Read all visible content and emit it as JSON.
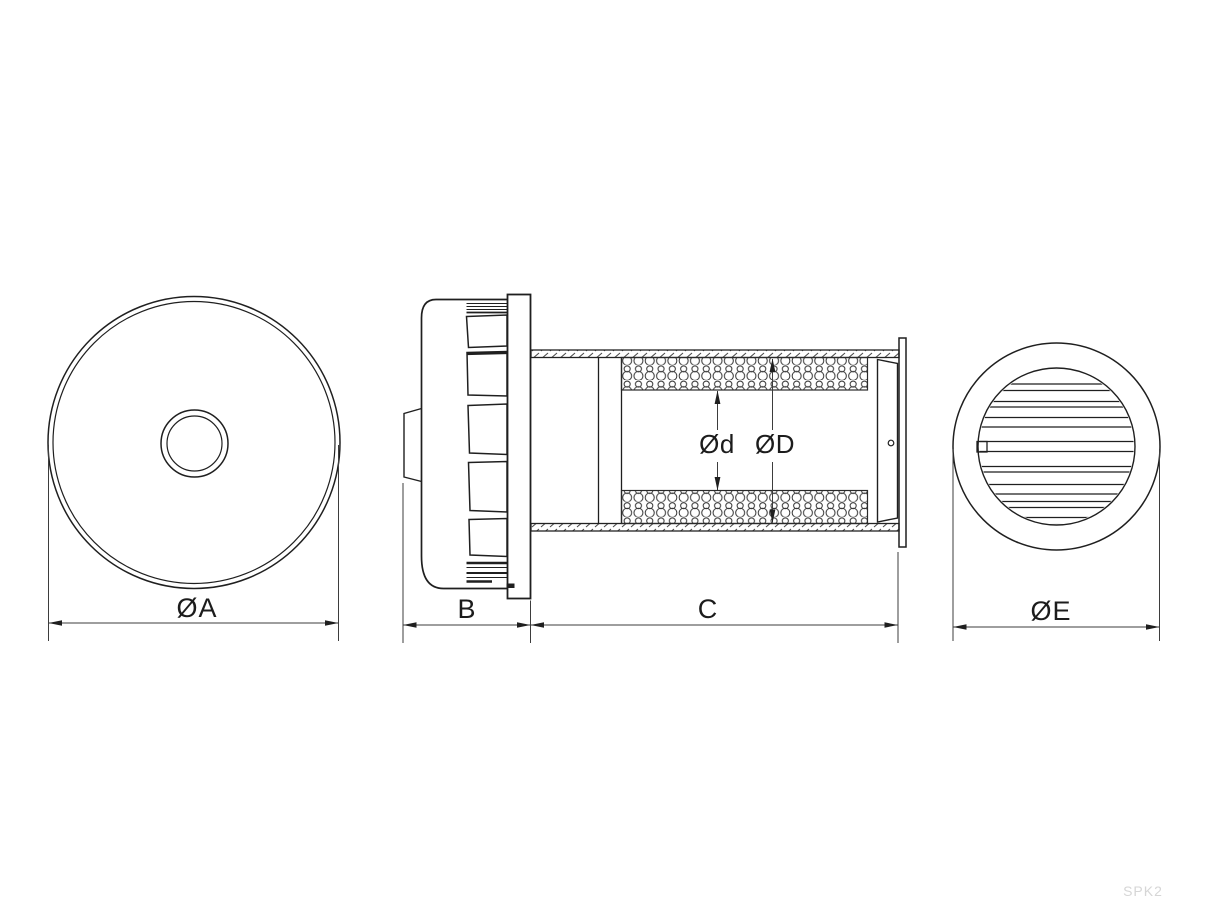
{
  "drawing": {
    "watermark": "SPK2",
    "colors": {
      "line": "#1f1f1f",
      "dimension_line": "#3d3d3d",
      "watermark": "#d6d6d6",
      "background": "#ffffff"
    },
    "views": {
      "front": {
        "dimension_label": "ØA"
      },
      "side": {
        "cap_depth_label": "B",
        "duct_length_label": "C",
        "inner_diameter_label": "Ød",
        "outer_diameter_label": "ØD"
      },
      "grille": {
        "dimension_label": "ØE"
      }
    }
  }
}
